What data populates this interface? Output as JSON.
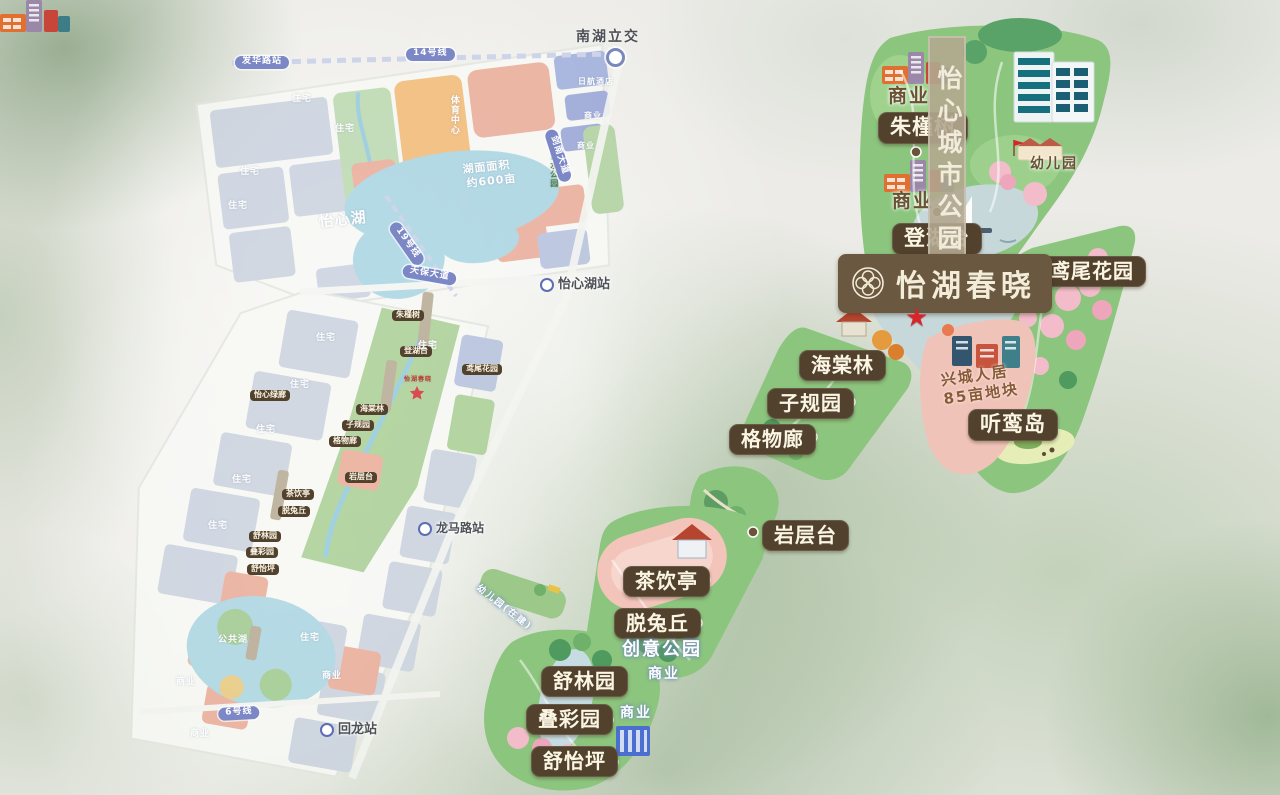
{
  "title": {
    "text": "怡湖春晓"
  },
  "icons": {
    "star": "★",
    "flower_logo": "four-petal-flower"
  },
  "palette": {
    "badge_brown": "#51412d",
    "title_brown": "#6b5840",
    "ribbon_tan": "#b2a78f",
    "park_green": "#8cc57e",
    "star_red": "#d6252b",
    "pink_area": "#f0c3b8",
    "metro_purple": "#7c87c6",
    "label_brown": "#6b5133"
  },
  "right_map": {
    "ribbon": "怡心城市公园",
    "dev": {
      "line1": "兴城人居",
      "line2": "85亩地块"
    },
    "badges": [
      {
        "name": "badge-zhujinshu",
        "label": "朱槿树",
        "x": 878,
        "y": 112,
        "fs": 21
      },
      {
        "name": "badge-denghutai",
        "label": "登湖台",
        "x": 892,
        "y": 223,
        "fs": 21
      },
      {
        "name": "badge-yanweihuayuan",
        "label": "鸢尾花园",
        "x": 1038,
        "y": 256,
        "fs": 20
      },
      {
        "name": "badge-haitanglin",
        "label": "海棠林",
        "x": 799,
        "y": 350,
        "fs": 20
      },
      {
        "name": "badge-ziguiyuan",
        "label": "子规园",
        "x": 767,
        "y": 388,
        "fs": 20
      },
      {
        "name": "badge-gewulang",
        "label": "格物廊",
        "x": 729,
        "y": 424,
        "fs": 20
      },
      {
        "name": "badge-tingluandao",
        "label": "听鸾岛",
        "x": 968,
        "y": 409,
        "fs": 21
      },
      {
        "name": "badge-yancengtai",
        "label": "岩层台",
        "x": 762,
        "y": 520,
        "fs": 20
      },
      {
        "name": "badge-chayinting",
        "label": "茶饮亭",
        "x": 623,
        "y": 566,
        "fs": 20
      },
      {
        "name": "badge-tuotuqiu",
        "label": "脱兔丘",
        "x": 614,
        "y": 608,
        "fs": 20
      },
      {
        "name": "badge-shulinyuan",
        "label": "舒林园",
        "x": 541,
        "y": 666,
        "fs": 20
      },
      {
        "name": "badge-diecaiyuan",
        "label": "叠彩园",
        "x": 526,
        "y": 704,
        "fs": 20
      },
      {
        "name": "badge-shuyiping",
        "label": "舒怡坪",
        "x": 531,
        "y": 746,
        "fs": 20
      }
    ],
    "labels": [
      {
        "name": "label-shangye-top1",
        "label": "商业",
        "x": 888,
        "y": 86,
        "fs": 19,
        "color": "#6b5133"
      },
      {
        "name": "label-shangye-top2",
        "label": "商业",
        "x": 892,
        "y": 191,
        "fs": 19,
        "color": "#6b5133"
      },
      {
        "name": "label-youeryuan",
        "label": "幼儿园",
        "x": 1030,
        "y": 157,
        "fs": 14,
        "color": "#6b5133"
      },
      {
        "name": "label-chuangyigongyuan",
        "label": "创意公园",
        "x": 622,
        "y": 640,
        "fs": 18,
        "color": "#ffffff"
      },
      {
        "name": "label-shangye-mid",
        "label": "商业",
        "x": 648,
        "y": 667,
        "fs": 14,
        "color": "#ffffff"
      },
      {
        "name": "label-shangye-bottom",
        "label": "商业",
        "x": 620,
        "y": 706,
        "fs": 14,
        "color": "#ffffff"
      },
      {
        "name": "label-youeryuan-zaijian",
        "label": "幼儿园(在建)",
        "x": 480,
        "y": 584,
        "fs": 9,
        "color": "#ffffff",
        "rotate": 38
      }
    ]
  },
  "left_map": {
    "interchange": {
      "label": "南湖立交"
    },
    "badges": [
      {
        "name": "mini-badge-yixinlvlang",
        "label": "怡心绿廊",
        "x": 250,
        "y": 390
      },
      {
        "name": "mini-badge-zhujinshu",
        "label": "朱槿树",
        "x": 392,
        "y": 310
      },
      {
        "name": "mini-badge-denghutai",
        "label": "登湖台",
        "x": 400,
        "y": 346
      },
      {
        "name": "mini-badge-yanweihuayuan",
        "label": "鸢尾花园",
        "x": 462,
        "y": 364
      },
      {
        "name": "mini-badge-haitanglin",
        "label": "海棠林",
        "x": 356,
        "y": 404
      },
      {
        "name": "mini-badge-ziguiyuan",
        "label": "子规园",
        "x": 342,
        "y": 420
      },
      {
        "name": "mini-badge-gewulang",
        "label": "格物廊",
        "x": 329,
        "y": 436
      },
      {
        "name": "mini-badge-yancengtai",
        "label": "岩层台",
        "x": 345,
        "y": 472
      },
      {
        "name": "mini-badge-chayinting",
        "label": "茶饮亭",
        "x": 282,
        "y": 489
      },
      {
        "name": "mini-badge-tuotuqiu",
        "label": "脱兔丘",
        "x": 278,
        "y": 506
      },
      {
        "name": "mini-badge-shulinyuan",
        "label": "舒林园",
        "x": 249,
        "y": 531
      },
      {
        "name": "mini-badge-diecaiyuan",
        "label": "叠彩园",
        "x": 246,
        "y": 547
      },
      {
        "name": "mini-badge-shuyiping",
        "label": "舒怡坪",
        "x": 247,
        "y": 564
      }
    ],
    "pills": [
      {
        "name": "pill-fahualuzhan",
        "label": "发华路站",
        "x": 235,
        "y": 56
      },
      {
        "name": "pill-line14",
        "label": "14号线",
        "x": 406,
        "y": 48
      },
      {
        "name": "pill-line19",
        "label": "19号线",
        "x": 398,
        "y": 220,
        "rotate": 55
      },
      {
        "name": "pill-tianbaodadao",
        "label": "天保大道",
        "x": 404,
        "y": 264,
        "rotate": 10
      },
      {
        "name": "pill-jiannandadao",
        "label": "剑南大道",
        "x": 556,
        "y": 128,
        "rotate": 72
      },
      {
        "name": "pill-line6",
        "label": "6号线",
        "x": 218,
        "y": 708,
        "rotate": -3
      }
    ],
    "stations": [
      {
        "name": "station-yixinhuzhan",
        "label": "怡心湖站",
        "x": 540,
        "y": 278,
        "fs": 13,
        "icon": "metro-icon"
      },
      {
        "name": "station-longmaluzhan",
        "label": "龙马路站",
        "x": 418,
        "y": 522,
        "fs": 12,
        "icon": "metro-icon"
      },
      {
        "name": "station-huilongzhan",
        "label": "回龙站",
        "x": 320,
        "y": 723,
        "fs": 13,
        "icon": "metro-icon"
      }
    ],
    "labels": [
      {
        "name": "label-yixinhu",
        "label": "怡心湖",
        "x": 318,
        "y": 214,
        "fs": 15,
        "rotate": -6
      },
      {
        "name": "label-lake-area-1",
        "label": "湖面面积",
        "x": 462,
        "y": 164,
        "fs": 11,
        "rotate": -6
      },
      {
        "name": "label-lake-area-2",
        "label": "约600亩",
        "x": 466,
        "y": 178,
        "fs": 11,
        "rotate": -6
      },
      {
        "name": "label-rihangjiudian",
        "label": "日航酒店",
        "x": 578,
        "y": 78,
        "fs": 8
      },
      {
        "name": "label-shangye-a",
        "label": "商业",
        "x": 584,
        "y": 112,
        "fs": 8
      },
      {
        "name": "label-shangye-b",
        "label": "商业",
        "x": 577,
        "y": 142,
        "fs": 8
      },
      {
        "name": "label-xushuigongyuan",
        "label": "蓄水公园",
        "x": 549,
        "y": 152,
        "fs": 8,
        "color": "#4e7d46",
        "vertical": true
      },
      {
        "name": "label-tiyuzhongxin",
        "label": "体育中心",
        "x": 448,
        "y": 95,
        "fs": 9,
        "vertical": true
      },
      {
        "name": "label-zhuzhai-1",
        "label": "住宅",
        "x": 292,
        "y": 95
      },
      {
        "name": "label-zhuzhai-2",
        "label": "住宅",
        "x": 335,
        "y": 125
      },
      {
        "name": "label-zhuzhai-3",
        "label": "住宅",
        "x": 240,
        "y": 168
      },
      {
        "name": "label-zhuzhai-4",
        "label": "住宅",
        "x": 228,
        "y": 202
      },
      {
        "name": "label-zhuzhai-5",
        "label": "住宅",
        "x": 316,
        "y": 334
      },
      {
        "name": "label-zhuzhai-6",
        "label": "住宅",
        "x": 290,
        "y": 381
      },
      {
        "name": "label-zhuzhai-7",
        "label": "住宅",
        "x": 256,
        "y": 426
      },
      {
        "name": "label-zhuzhai-8",
        "label": "住宅",
        "x": 232,
        "y": 476
      },
      {
        "name": "label-zhuzhai-9",
        "label": "住宅",
        "x": 208,
        "y": 522
      },
      {
        "name": "label-zhuzhai-10",
        "label": "住宅",
        "x": 418,
        "y": 342
      },
      {
        "name": "label-zhuzhai-11",
        "label": "住宅",
        "x": 300,
        "y": 634
      },
      {
        "name": "label-gonggonghu",
        "label": "公共湖",
        "x": 218,
        "y": 636
      },
      {
        "name": "label-shangye-c",
        "label": "商业",
        "x": 176,
        "y": 678
      },
      {
        "name": "label-shangye-d",
        "label": "商业",
        "x": 190,
        "y": 730
      },
      {
        "name": "label-shangye-e",
        "label": "商业",
        "x": 322,
        "y": 672
      },
      {
        "name": "label-yihuchunxiao-mini",
        "label": "怡湖春晓",
        "x": 404,
        "y": 377,
        "fs": 6,
        "color": "#c0392b"
      }
    ]
  }
}
